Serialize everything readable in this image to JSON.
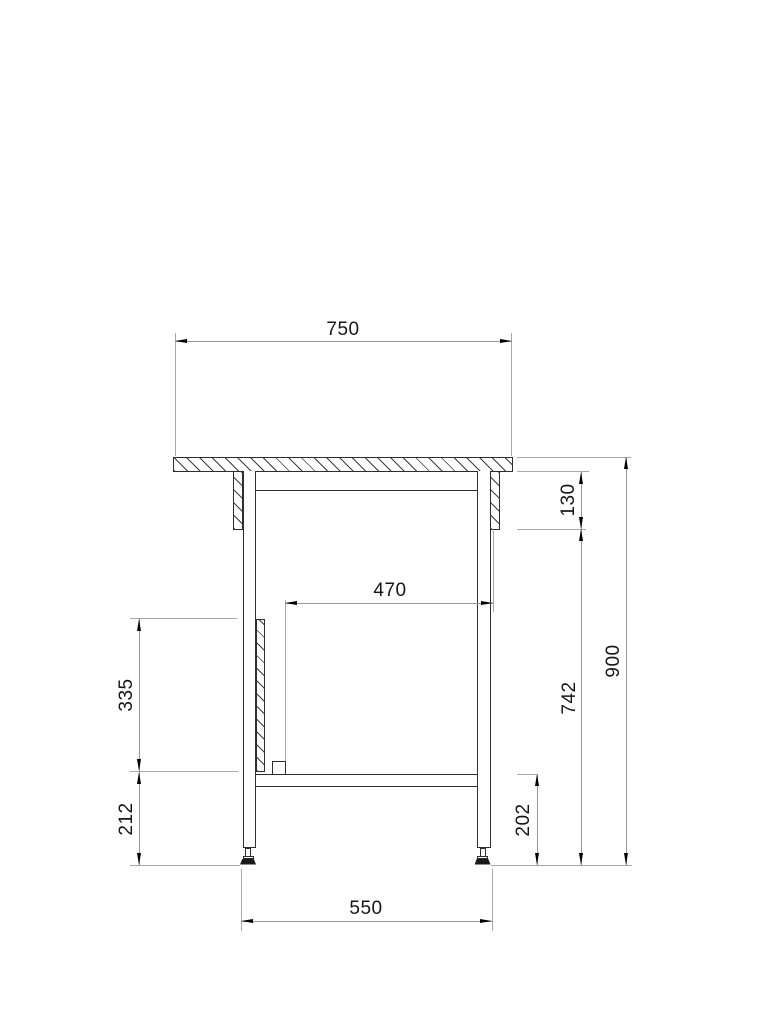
{
  "dims": {
    "top_width": "750",
    "clear_width": "470",
    "bracket_drop": "130",
    "panel_length": "335",
    "leg_lower": "212",
    "under_top_height": "742",
    "overall_height": "900",
    "shelf_height": "202",
    "foot_span": "550"
  },
  "colors": {
    "object_line": "#2e2e2e",
    "dimension_line": "#969696",
    "arrow": "#000000",
    "text": "#161616",
    "background": "#ffffff"
  }
}
